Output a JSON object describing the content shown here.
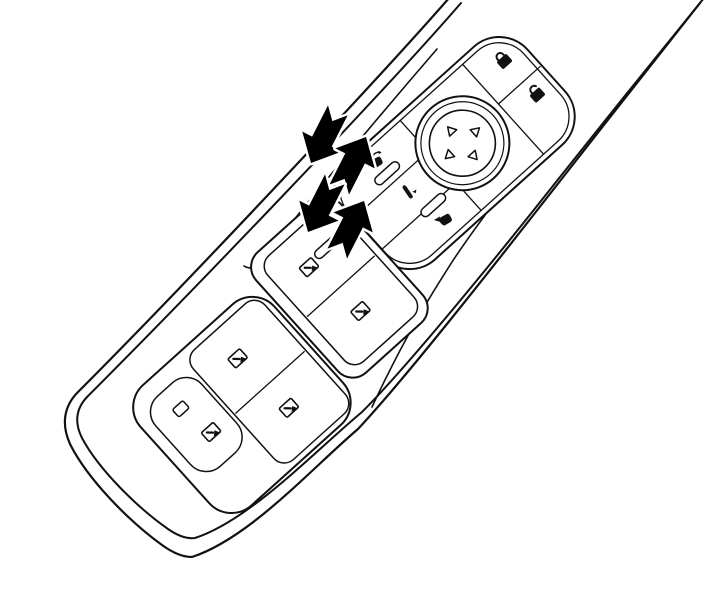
{
  "diagram": {
    "subject": "Driver door armrest switch panel line-art illustration",
    "style": "black and white technical drawing, panel rotated diagonally",
    "colors": {
      "background": "#ffffff",
      "line": "#111111",
      "arrow_fill": "#000000"
    },
    "door_panel": {
      "label": "door-panel-outline"
    },
    "armrest": {
      "label": "armrest-edge-lines"
    },
    "upper_cluster": {
      "label": "mirror-and-lock-control-cluster",
      "lock_buttons": [
        {
          "label": "central-locking-lock-button",
          "icon": "padlock-closed-icon"
        },
        {
          "label": "central-locking-unlock-button",
          "icon": "padlock-open-icon"
        }
      ],
      "mirror_adjust_pad": {
        "label": "mirror-four-way-adjuster-pad",
        "icon": "four-way-pad-icon",
        "triangle_directions": [
          "up",
          "right",
          "down",
          "left"
        ]
      },
      "mirror_select_buttons": [
        {
          "label": "left-mirror-select-button",
          "icon": "mirror-left-icon"
        },
        {
          "label": "mirror-fold-button",
          "icon": "mirror-fold-icon"
        },
        {
          "label": "right-mirror-select-button",
          "icon": "mirror-right-icon"
        }
      ]
    },
    "window_switch_bank": {
      "label": "power-window-switch-bank",
      "rear_pair": [
        {
          "label": "rear-window-switch-1",
          "icon": "power-window-icon"
        },
        {
          "label": "rear-window-switch-2",
          "icon": "power-window-icon"
        }
      ],
      "front_pair": [
        {
          "label": "front-window-switch-1",
          "icon": "power-window-icon"
        },
        {
          "label": "front-window-switch-2",
          "icon": "power-window-icon"
        }
      ],
      "driver_section": [
        {
          "label": "rear-window-lockout-button",
          "icon": "blank-rectangle-icon"
        },
        {
          "label": "driver-window-switch",
          "icon": "power-window-icon"
        }
      ]
    },
    "motion_arrows": {
      "label": "switch-rocker-motion-arrows",
      "pairs": [
        {
          "label": "upper-arrow-pair",
          "directions": [
            "press-down",
            "pull-up"
          ]
        },
        {
          "label": "lower-arrow-pair",
          "directions": [
            "press-down",
            "pull-up"
          ]
        }
      ]
    }
  }
}
